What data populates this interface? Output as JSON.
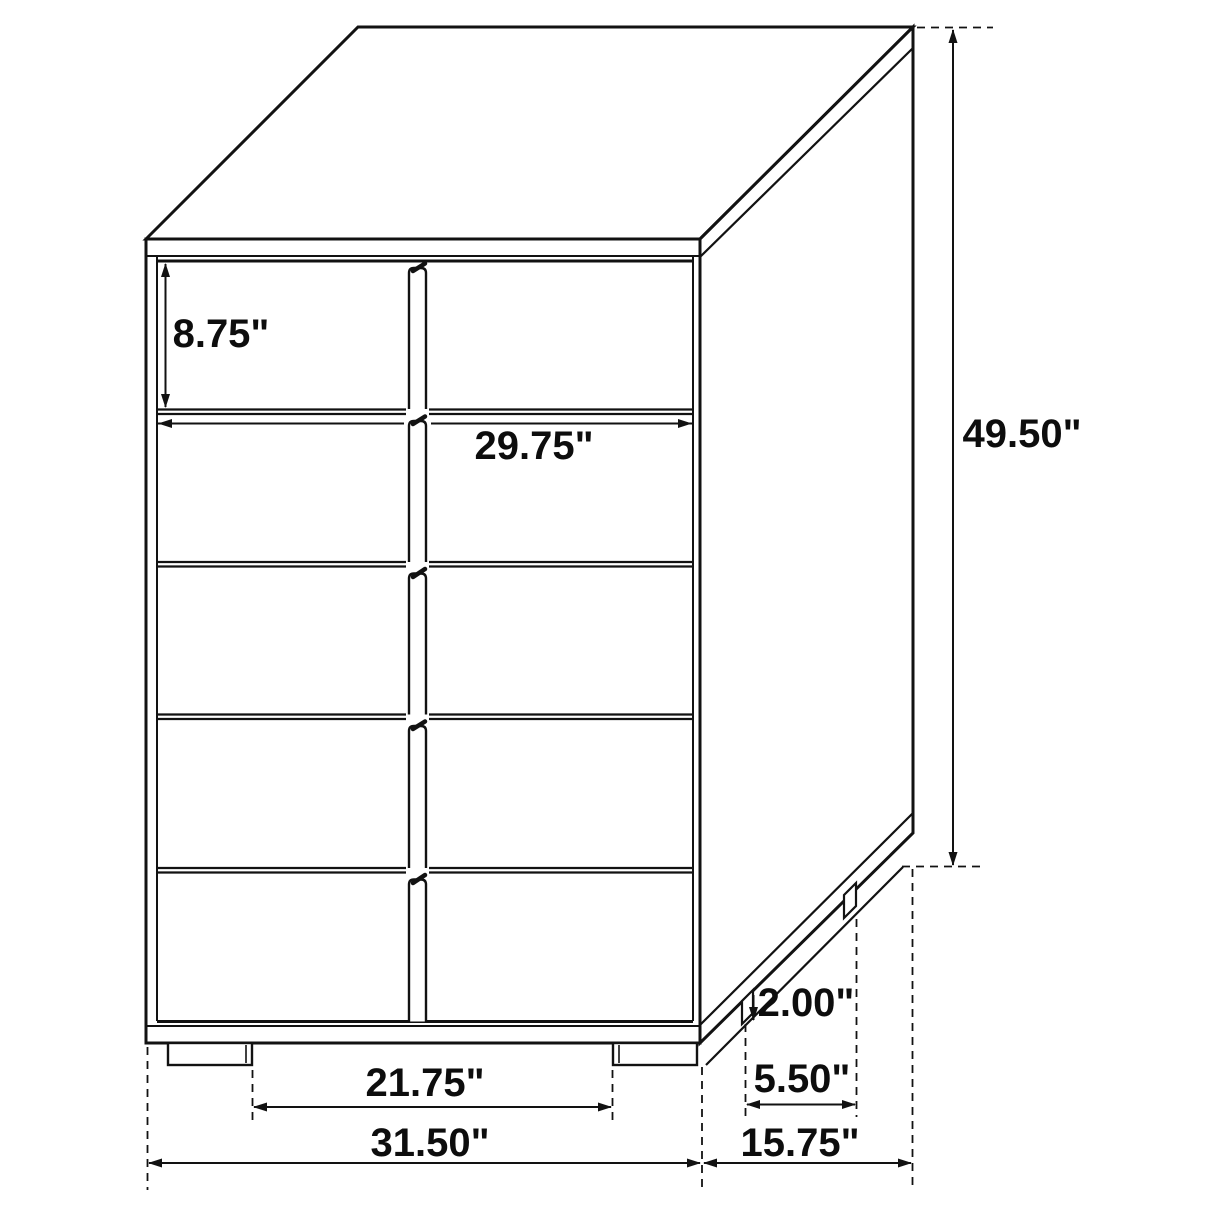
{
  "diagram": {
    "type": "furniture-dimension-drawing",
    "subject": "5-drawer chest, oblique projection",
    "unit": "inches",
    "line_color": "#121212",
    "background": "#ffffff",
    "dimensions": {
      "drawer_height": "8.75\"",
      "opening_width": "29.75\"",
      "overall_height": "49.50\"",
      "leg_height": "2.00\"",
      "side_leg_span": "5.50\"",
      "front_leg_gap": "21.75\"",
      "overall_width": "31.50\"",
      "overall_depth": "15.75\""
    }
  }
}
